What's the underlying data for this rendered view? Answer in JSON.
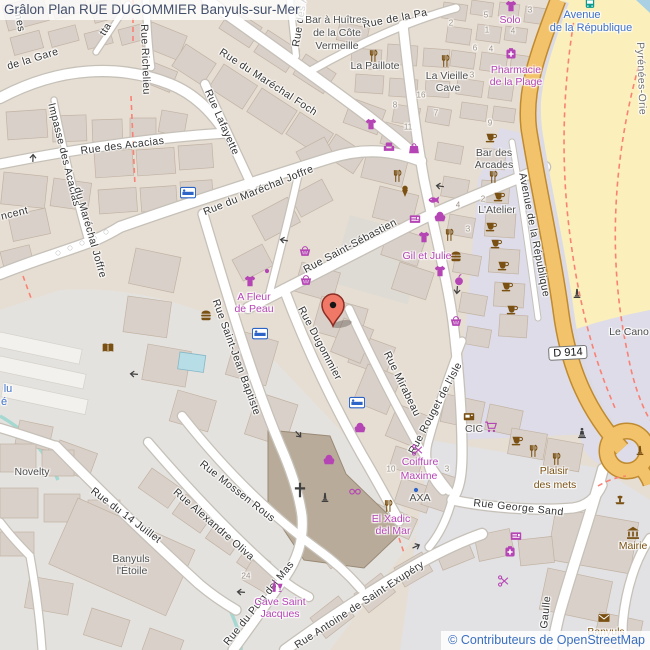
{
  "title": "Grâlon Plan RUE DUGOMMIER Banyuls-sur-Mer",
  "attribution": "© Contributeurs de OpenStreetMap",
  "colors": {
    "poi_magenta": "#b545b5",
    "poi_brown": "#7a5113",
    "poi_blue": "#3f6fc5",
    "road_orange": "#f3c36b",
    "beach_sand": "#fbf0bb",
    "marker_red": "#ef7866"
  },
  "map": {
    "labels": [
      {
        "t": "de la Gare",
        "x": 6,
        "y": 62,
        "r": -17,
        "c": "st"
      },
      {
        "t": "mes",
        "x": 22,
        "y": 10,
        "r": 78,
        "c": "st"
      },
      {
        "t": "Rue Richelieu",
        "x": 149,
        "y": 24,
        "r": 88,
        "c": "st"
      },
      {
        "t": "tta",
        "x": 98,
        "y": 32,
        "r": -58,
        "c": "st"
      },
      {
        "t": "Rue du Maréchal Foch",
        "x": 223,
        "y": 47,
        "r": 33,
        "c": "st"
      },
      {
        "t": "Rue des Alb",
        "x": 291,
        "y": 46,
        "r": -81,
        "c": "st"
      },
      {
        "t": "Rue Lafayette",
        "x": 212,
        "y": 88,
        "r": 66,
        "c": "st"
      },
      {
        "t": "Rue des Acacias",
        "x": 80,
        "y": 146,
        "r": -7,
        "c": "st"
      },
      {
        "t": "Impasse des Acacias",
        "x": 56,
        "y": 102,
        "r": 76,
        "c": "st"
      },
      {
        "t": "du Maréchal Joffre",
        "x": 82,
        "y": 186,
        "r": 74,
        "c": "st"
      },
      {
        "t": "ncent",
        "x": 0,
        "y": 212,
        "r": -14,
        "c": "st"
      },
      {
        "t": "Rue du Maréchal Joffre",
        "x": 202,
        "y": 208,
        "r": -22,
        "c": "st"
      },
      {
        "t": "Rue Saint-Sébastien",
        "x": 302,
        "y": 266,
        "r": -28,
        "c": "st"
      },
      {
        "t": "Rue Dugommier",
        "x": 305,
        "y": 305,
        "r": 62,
        "c": "st"
      },
      {
        "t": "Rue Mirabeau",
        "x": 391,
        "y": 350,
        "r": 64,
        "c": "st"
      },
      {
        "t": "Rue Rouget de l'Isle",
        "x": 407,
        "y": 451,
        "r": -62,
        "c": "st"
      },
      {
        "t": "Rue Saint-Jean Baptiste",
        "x": 220,
        "y": 298,
        "r": 70,
        "c": "st"
      },
      {
        "t": "Rue Mossen Rous",
        "x": 204,
        "y": 459,
        "r": 38,
        "c": "st"
      },
      {
        "t": "Rue Alexandre Oliva",
        "x": 178,
        "y": 487,
        "r": 41,
        "c": "st"
      },
      {
        "t": "Rue du 14 Juillet",
        "x": 95,
        "y": 486,
        "r": 37,
        "c": "st"
      },
      {
        "t": "Rue du Puig del Mas",
        "x": 222,
        "y": 641,
        "r": -51,
        "c": "st"
      },
      {
        "t": "Rue Antoine de Saint-Exupéry",
        "x": 293,
        "y": 642,
        "r": -33,
        "c": "st"
      },
      {
        "t": "Rue George Sand",
        "x": 474,
        "y": 498,
        "r": 6,
        "c": "st"
      },
      {
        "t": "Gaulle",
        "x": 539,
        "y": 628,
        "r": -84,
        "c": "st"
      },
      {
        "t": "Avenue de la République",
        "x": 527,
        "y": 172,
        "r": 79,
        "c": "st"
      },
      {
        "t": "Rue de la Pa",
        "x": 362,
        "y": 20,
        "r": -11,
        "c": "st"
      },
      {
        "t": "Pyrénées-Orie",
        "x": 645,
        "y": 42,
        "r": 88,
        "c": "gst"
      },
      {
        "t": "Solo",
        "x": 510,
        "y": 21,
        "c": "poi"
      },
      {
        "t": "Pharmacie",
        "x": 516,
        "y": 71,
        "c": "poi"
      },
      {
        "t": "de la Plage",
        "x": 516,
        "y": 83,
        "c": "poi"
      },
      {
        "t": "Gil et Julie",
        "x": 427,
        "y": 257,
        "c": "poi"
      },
      {
        "t": "A Fleur",
        "x": 254,
        "y": 298,
        "c": "poi"
      },
      {
        "t": "de Peau",
        "x": 254,
        "y": 310,
        "c": "poi"
      },
      {
        "t": "Coiffure",
        "x": 420,
        "y": 463,
        "c": "poi"
      },
      {
        "t": "Maxime",
        "x": 419,
        "y": 477,
        "c": "poi"
      },
      {
        "t": "El Xadic",
        "x": 391,
        "y": 520,
        "c": "poi"
      },
      {
        "t": "del Mar",
        "x": 393,
        "y": 532,
        "c": "poi"
      },
      {
        "t": "Cave Saint",
        "x": 280,
        "y": 603,
        "c": "poi"
      },
      {
        "t": "Jacques",
        "x": 280,
        "y": 615,
        "c": "poi"
      },
      {
        "t": "Bar à Huîtres",
        "x": 336,
        "y": 21,
        "c": "gpoi"
      },
      {
        "t": "de la Côte",
        "x": 337,
        "y": 34,
        "c": "gpoi"
      },
      {
        "t": "Vermeille",
        "x": 337,
        "y": 47,
        "c": "gpoi"
      },
      {
        "t": "La Paillote",
        "x": 375,
        "y": 67,
        "c": "gpoi"
      },
      {
        "t": "La Vieille",
        "x": 447,
        "y": 77,
        "c": "gpoi"
      },
      {
        "t": "Cave",
        "x": 448,
        "y": 89,
        "c": "gpoi"
      },
      {
        "t": "Bar des",
        "x": 494,
        "y": 154,
        "c": "gpoi"
      },
      {
        "t": "Arcades",
        "x": 494,
        "y": 166,
        "c": "gpoi"
      },
      {
        "t": "L'Atelier",
        "x": 497,
        "y": 211,
        "c": "gpoi"
      },
      {
        "t": "CIC",
        "x": 474,
        "y": 430,
        "c": "gpoi"
      },
      {
        "t": "AXA",
        "x": 420,
        "y": 499,
        "c": "gpoi"
      },
      {
        "t": "Novelty",
        "x": 32,
        "y": 473,
        "c": "gpoi"
      },
      {
        "t": "Banyuls",
        "x": 131,
        "y": 560,
        "c": "gpoi"
      },
      {
        "t": "l'Étoile",
        "x": 132,
        "y": 572,
        "c": "gpoi"
      },
      {
        "t": "Le Cano",
        "x": 629,
        "y": 333,
        "c": "gpoi"
      },
      {
        "t": "Plaisir",
        "x": 554,
        "y": 472,
        "c": "bpoi"
      },
      {
        "t": "des mets",
        "x": 555,
        "y": 486,
        "c": "bpoi"
      },
      {
        "t": "Mairie",
        "x": 633,
        "y": 547,
        "c": "bpoi"
      },
      {
        "t": "Banyuls",
        "x": 606,
        "y": 633,
        "c": "bpoi"
      },
      {
        "t": "Avenue",
        "x": 582,
        "y": 15,
        "c": "blpoi"
      },
      {
        "t": "de la République",
        "x": 591,
        "y": 28,
        "c": "blpoi"
      },
      {
        "t": "lu",
        "x": 8,
        "y": 389,
        "c": "blpoi"
      },
      {
        "t": "é",
        "x": 4,
        "y": 402,
        "c": "blpoi"
      },
      {
        "t": "D 914",
        "x": 568,
        "y": 353,
        "r": -3,
        "c": "shield"
      },
      {
        "t": "5",
        "x": 486,
        "y": 16,
        "c": "hn"
      },
      {
        "t": "3",
        "x": 530,
        "y": 11,
        "c": "hn"
      },
      {
        "t": "2",
        "x": 451,
        "y": 24,
        "c": "hn"
      },
      {
        "t": "1",
        "x": 487,
        "y": 31,
        "c": "hn"
      },
      {
        "t": "4",
        "x": 513,
        "y": 32,
        "c": "hn"
      },
      {
        "t": "6",
        "x": 475,
        "y": 49,
        "c": "hn"
      },
      {
        "t": "4",
        "x": 491,
        "y": 50,
        "c": "hn"
      },
      {
        "t": "3",
        "x": 472,
        "y": 76,
        "c": "hn"
      },
      {
        "t": "16",
        "x": 421,
        "y": 96,
        "c": "hn"
      },
      {
        "t": "8",
        "x": 395,
        "y": 106,
        "c": "hn"
      },
      {
        "t": "7",
        "x": 436,
        "y": 114,
        "c": "hn"
      },
      {
        "t": "9",
        "x": 490,
        "y": 124,
        "c": "hn"
      },
      {
        "t": "11",
        "x": 408,
        "y": 128,
        "c": "hn"
      },
      {
        "t": "2",
        "x": 483,
        "y": 200,
        "c": "hn"
      },
      {
        "t": "4",
        "x": 458,
        "y": 206,
        "c": "hn"
      },
      {
        "t": "3",
        "x": 468,
        "y": 230,
        "c": "hn"
      },
      {
        "t": "10",
        "x": 391,
        "y": 470,
        "c": "hn"
      },
      {
        "t": "3",
        "x": 447,
        "y": 470,
        "c": "hn"
      },
      {
        "t": "24",
        "x": 246,
        "y": 577,
        "c": "hn"
      }
    ],
    "icons": [
      {
        "name": "clothing-icon",
        "x": 511,
        "y": 6,
        "c": "m"
      },
      {
        "name": "pharmacy-icon",
        "x": 511,
        "y": 54,
        "c": "m"
      },
      {
        "name": "clothing-icon",
        "x": 371,
        "y": 124,
        "c": "m"
      },
      {
        "name": "furniture-icon",
        "x": 389,
        "y": 147,
        "c": "m"
      },
      {
        "name": "bag-icon",
        "x": 414,
        "y": 148,
        "c": "m"
      },
      {
        "name": "fishmonger-icon",
        "x": 434,
        "y": 200,
        "c": "m"
      },
      {
        "name": "newsagent-icon",
        "x": 415,
        "y": 219,
        "c": "m"
      },
      {
        "name": "bakery-icon",
        "x": 440,
        "y": 216,
        "c": "m"
      },
      {
        "name": "clothing-icon",
        "x": 424,
        "y": 237,
        "c": "m"
      },
      {
        "name": "clothing-icon",
        "x": 440,
        "y": 271,
        "c": "m"
      },
      {
        "name": "greengrocer-icon",
        "x": 459,
        "y": 280,
        "c": "m"
      },
      {
        "name": "convenience-icon",
        "x": 456,
        "y": 321,
        "c": "m"
      },
      {
        "name": "convenience-icon",
        "x": 305,
        "y": 251,
        "c": "m"
      },
      {
        "name": "convenience-icon",
        "x": 306,
        "y": 280,
        "c": "m"
      },
      {
        "name": "clothing-icon",
        "x": 250,
        "y": 281,
        "c": "m"
      },
      {
        "name": "poi-dot-icon",
        "x": 267,
        "y": 271,
        "c": "m"
      },
      {
        "name": "optician-icon",
        "x": 355,
        "y": 491,
        "c": "m"
      },
      {
        "name": "bakery-icon",
        "x": 329,
        "y": 459,
        "c": "m"
      },
      {
        "name": "bakery-icon",
        "x": 360,
        "y": 427,
        "c": "m"
      },
      {
        "name": "hairdresser-icon",
        "x": 418,
        "y": 450,
        "c": "m"
      },
      {
        "name": "pharmacy-icon",
        "x": 510,
        "y": 552,
        "c": "m"
      },
      {
        "name": "newsagent-icon",
        "x": 516,
        "y": 536,
        "c": "m"
      },
      {
        "name": "beauty-icon",
        "x": 504,
        "y": 581,
        "c": "m"
      },
      {
        "name": "supermarket-icon",
        "x": 491,
        "y": 427,
        "c": "m"
      },
      {
        "name": "wine-shop-icon",
        "x": 277,
        "y": 586,
        "c": "m"
      },
      {
        "name": "restaurant-icon",
        "x": 373,
        "y": 56,
        "c": "b"
      },
      {
        "name": "restaurant-icon",
        "x": 445,
        "y": 61,
        "c": "b"
      },
      {
        "name": "cafe-icon",
        "x": 491,
        "y": 137,
        "c": "b"
      },
      {
        "name": "restaurant-icon",
        "x": 493,
        "y": 177,
        "c": "b"
      },
      {
        "name": "cafe-icon",
        "x": 499,
        "y": 196,
        "c": "b"
      },
      {
        "name": "cafe-icon",
        "x": 491,
        "y": 226,
        "c": "b"
      },
      {
        "name": "cafe-icon",
        "x": 496,
        "y": 243,
        "c": "b"
      },
      {
        "name": "cafe-icon",
        "x": 503,
        "y": 265,
        "c": "b"
      },
      {
        "name": "cafe-icon",
        "x": 507,
        "y": 286,
        "c": "b"
      },
      {
        "name": "cafe-icon",
        "x": 512,
        "y": 309,
        "c": "b"
      },
      {
        "name": "restaurant-icon",
        "x": 397,
        "y": 176,
        "c": "b"
      },
      {
        "name": "ice-cream-icon",
        "x": 405,
        "y": 191,
        "c": "b"
      },
      {
        "name": "restaurant-icon",
        "x": 449,
        "y": 235,
        "c": "b"
      },
      {
        "name": "fast-food-icon",
        "x": 456,
        "y": 256,
        "c": "b"
      },
      {
        "name": "fast-food-icon",
        "x": 206,
        "y": 315,
        "c": "b"
      },
      {
        "name": "library-icon",
        "x": 108,
        "y": 348,
        "c": "b"
      },
      {
        "name": "restaurant-icon",
        "x": 388,
        "y": 506,
        "c": "b"
      },
      {
        "name": "cafe-icon",
        "x": 517,
        "y": 440,
        "c": "b"
      },
      {
        "name": "restaurant-icon",
        "x": 533,
        "y": 451,
        "c": "b"
      },
      {
        "name": "restaurant-icon",
        "x": 556,
        "y": 459,
        "c": "b"
      },
      {
        "name": "bank-icon",
        "x": 469,
        "y": 417,
        "c": "b"
      },
      {
        "name": "townhall-icon",
        "x": 633,
        "y": 533,
        "c": "b"
      },
      {
        "name": "post-office-icon",
        "x": 604,
        "y": 618,
        "c": "b"
      },
      {
        "name": "fountain-icon",
        "x": 620,
        "y": 501,
        "c": "b"
      },
      {
        "name": "monument-icon",
        "x": 640,
        "y": 451,
        "c": "b"
      },
      {
        "name": "statue-icon",
        "x": 582,
        "y": 433,
        "c": "d"
      },
      {
        "name": "monument-icon",
        "x": 577,
        "y": 294,
        "c": "d"
      },
      {
        "name": "monument-icon",
        "x": 325,
        "y": 498,
        "c": "d"
      },
      {
        "name": "church-cross-icon",
        "x": 300,
        "y": 490,
        "c": "d"
      },
      {
        "name": "hotel-icon",
        "x": 188,
        "y": 193,
        "c": "bl"
      },
      {
        "name": "hotel-icon",
        "x": 260,
        "y": 334,
        "c": "bl"
      },
      {
        "name": "hotel-icon",
        "x": 357,
        "y": 403,
        "c": "bl"
      },
      {
        "name": "poi-dot-icon",
        "x": 416,
        "y": 490,
        "c": "bl"
      },
      {
        "name": "bus-stop-icon",
        "x": 590,
        "y": 4,
        "c": "t"
      },
      {
        "name": "oneway-arrow-icon",
        "x": 439,
        "y": 186,
        "r": 188,
        "c": "d"
      },
      {
        "name": "oneway-arrow-icon",
        "x": 457,
        "y": 291,
        "r": 95,
        "c": "d"
      },
      {
        "name": "oneway-arrow-icon",
        "x": 283,
        "y": 240,
        "r": 190,
        "c": "d"
      },
      {
        "name": "oneway-arrow-icon",
        "x": 33,
        "y": 157,
        "r": -88,
        "c": "d"
      },
      {
        "name": "oneway-arrow-icon",
        "x": 133,
        "y": 374,
        "r": 184,
        "c": "d"
      },
      {
        "name": "oneway-arrow-icon",
        "x": 299,
        "y": 435,
        "r": 48,
        "c": "d"
      },
      {
        "name": "oneway-arrow-icon",
        "x": 417,
        "y": 546,
        "r": -25,
        "c": "d"
      },
      {
        "name": "oneway-arrow-icon",
        "x": 240,
        "y": 592,
        "r": 184,
        "c": "d"
      }
    ]
  }
}
